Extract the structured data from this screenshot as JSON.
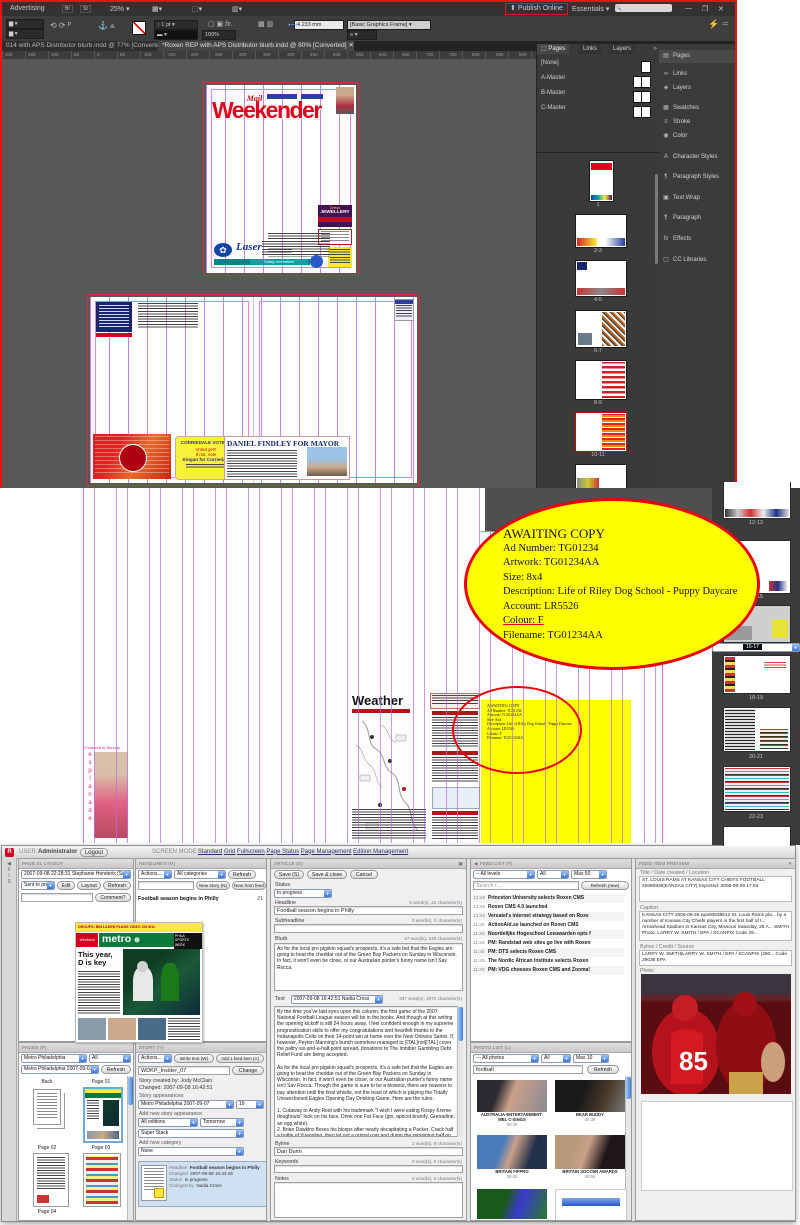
{
  "indesign": {
    "app_bar": {
      "workspace": "Advertising",
      "zoom": "25%",
      "publish": "Publish Online",
      "essentials": "Essentials"
    },
    "control_bar": {
      "stroke_weight": "1 pt",
      "percent": "100%",
      "measure": "4.233 mm",
      "frame_style": "[Basic Graphics Frame]"
    },
    "tabs": [
      {
        "label": "014 with APS Distributor blurb.indd @ 77% [Converted]"
      },
      {
        "label": "*Roxen REP with APS Distributor blurb.indd @ 80% [Converted]"
      }
    ],
    "ruler": [
      "200",
      "150",
      "100",
      "50",
      "0",
      "50",
      "100",
      "150",
      "200",
      "250",
      "300",
      "350",
      "400",
      "450",
      "500",
      "550",
      "600",
      "650",
      "700",
      "750",
      "800",
      "850",
      "900"
    ],
    "pages_panel": {
      "tabs": [
        "Pages",
        "Links",
        "Layers"
      ],
      "masters": [
        "[None]",
        "A-Master",
        "B-Master",
        "C-Master"
      ],
      "page_labels": [
        "1",
        "2-3",
        "4-5",
        "6-7",
        "8-9",
        "10-11"
      ]
    },
    "dock": [
      "Pages",
      "Links",
      "Layers",
      "Swatches",
      "Stroke",
      "Color",
      "Character Styles",
      "Paragraph Styles",
      "Text Wrap",
      "Paragraph",
      "Effects",
      "CC Libraries"
    ],
    "page1": {
      "masthead_small": "Mail",
      "masthead": "Weekender",
      "laser": "Laser",
      "jewellery1": "Dress",
      "jewellery2": "JEWELLERY",
      "totally": "Totally Incredible!"
    },
    "spread": {
      "yellow_ad": {
        "l1": "CORRIEDALE VOTERS",
        "l2": "Voted yet?",
        "l3": "If not, vote",
        "l4": "Kingan for Corriedale"
      },
      "mayor_ad": {
        "title": "DANIEL FINDLEY FOR MAYOR"
      }
    }
  },
  "zoom_view": {
    "thumb_labels": [
      "12-13",
      "14-15",
      "16-17",
      "18-19",
      "20-21",
      "22-23"
    ],
    "weather_title": "Weather",
    "featured": {
      "caption": "Featured in Sunday",
      "vertical": "esplanade"
    },
    "ticket": {
      "title": "AWAITING COPY",
      "ad_number": "Ad Number: TG01234",
      "artwork": "Artwork: TG01234AA",
      "size": "Size: 8x4",
      "description": "Description: Life of Riley Dog School - Puppy Daycare",
      "account": "Account: LR5526",
      "colour": "Colour: F",
      "filename": "Filename: TG01234AA"
    }
  },
  "cms": {
    "header": {
      "user_label": "USER:",
      "user": "Administrator",
      "logout": "Logout",
      "mode_label": "SCREEN MODE:",
      "nav": [
        "Standard",
        "Grid",
        "Fullscreen",
        "Page Status",
        "Page Management",
        "Edition Management"
      ]
    },
    "page_layout": {
      "title": "PAGE 01 LAYOUT",
      "revision": "2007-09-08 22:28:31 Stephanie Henderix (Sent t",
      "sent": "Sent to pre",
      "edit": "Edit",
      "layout": "Layout",
      "refresh": "Refresh",
      "comment": "Comment?"
    },
    "headlines": {
      "title": "HEADLINES (H)",
      "actions": "Actions...",
      "categories": "All categories",
      "refresh": "Refresh",
      "new_story": "New story (N)",
      "new_from_feed": "New from feed",
      "item": "Football season begins in Philly",
      "item_page": "21"
    },
    "preview": {
      "topline": "GROUPS: BIN LADEN PLANS VIDEO ON 9/11",
      "brand": "metro",
      "brand_left": "Weekend",
      "headline1": "This year,",
      "headline2": "D is key"
    },
    "pages": {
      "title": "PAGES (P)",
      "pub": "Metro Philadelphia",
      "all": "All",
      "edition": "Metro Philadelphia 2007-09-07",
      "refresh": "Refresh",
      "thumbs": [
        "Back",
        "Page 01",
        "Page 02",
        "Page 03",
        "Page 04"
      ]
    },
    "story": {
      "title": "STORY (Y)",
      "actions": "Actions...",
      "write": "Write text (W)",
      "add_feed": "Add 1 feed item (A)",
      "slug": "WDKP_Insider_07",
      "change": "Change",
      "created": "Story created by: Jody McClain",
      "changed": "Changed: 2007-09-08 16:42:51",
      "appearances_label": "Story appearances",
      "appearance": "Metro Philadelphia 2007-09-07",
      "page_no": "19",
      "add_appearance_label": "Add new story appearance",
      "editions": "All editions",
      "when": "Tomorrow",
      "stack": "Super Stack",
      "add_category_label": "Add new category",
      "category": "None",
      "item": {
        "headline_label": "Headline",
        "headline": "Football season begins in Philly",
        "changed_label": "Changed",
        "changed": "2007-09-08 16:43:45",
        "status_label": "Status",
        "status": "In progress",
        "by_label": "Changed by",
        "by": "Nadia Cross"
      }
    },
    "article": {
      "title": "ARTICLE (S)",
      "save": "Save (S)",
      "save_close": "Save & close",
      "cancel": "Cancel",
      "status_label": "Status",
      "status": "In progress",
      "headline_label": "Headline",
      "headline_count": "5 word(s), 32 character(s)",
      "headline": "Football season begins in Philly",
      "subheadline_label": "Subheadline",
      "subheadline_count": "0 word(s), 0 character(s)",
      "blurb_label": "Blurb",
      "blurb_count": "47 word(s), 246 character(s)",
      "blurb": "As for the local pro pigskin squad's prospects, it's a safe bet that the Eagles are going to beat the cheddar out of the Green Bay Packers on Sunday in Wisconsin. In fact, it won't even be close, or our Australian punter's funny name isn't Sav Rocca.",
      "text_label": "Text",
      "text_rev": "2007-09-08 16:42:51 Nadia Cross",
      "text_count": "337 word(s), 1972 character(s)",
      "text": "By the time you've laid eyes upon this column, the first game of the 2007 National Football League season will be in the books. And though at this writing the opening kickoff is still 24 hours away, I feel confident enough in my supreme prognostication skills to offer my congratulations and heartfelt thanks to the Indianapolis Colts on their 14-point win at home over the New Orleans Saints. If, however, Peyton Manning's bunch somehow managed to [ITAL]not[ITAL] cover the paltry six-and-a-half point spread, donations to The Imbiber Gambling Debt Relief Fund are being accepted.\n\nAs for the local pro pigskin squad's prospects, it's a safe bet that the Eagles are going to beat the cheddar out of the Green Bay Packers on Sunday in Wisconsin. In fact, it won't even be close, or our Australian punter's funny name isn't Sav Rocca. Though the game is sure to be a blowout, there are reasons to pay attention until the final whistle, not the least of which is playing the Totally Unsanctioned Eagles Opening Day Drinking Game. Here are the rules:\n\n1. Cutaway to Andy Reid with his trademark \"I wish I were eating Krispy Kreme doughnuts\" look on his face. Drink one Fat Face (gin, apricot brandy, Grenadine, an egg white).\n2. Brian Dawkins flexes his biceps after nearly decapitating a Packer. Crack half a bottle of Yuengling, then let out a primal roar and dump the remaining half on the head of the person sitting closest to you.\n3. Sav Rocca punts: Two sips of Foster's, which is Australian for beer. Too many punts, however, and you may want to \"chunder,\" which is Australian for puke.\n4. Donovan McNabb chunders: Think back to the exciting moments of Super Bowl XXXIX, then swallow a Bitter Pill (vodka, Jack Daniel, lemon juice, Coke).\n5. Hear the E-A-G-L-E-S chant emanating from the crowd at Lambeau Field: Raise a shot of Brass Balls (Grand Marnier, peach schnapps, pineapple juice) to intrepid Birds fans everywhere.\n\nFinal score prediction: Eagles 24, Packers 16.",
      "byline_label": "Byline",
      "byline_count": "2 word(s), 8 character(s)",
      "byline": "Dan Dunn",
      "keywords_label": "Keywords",
      "keywords_count": "0 word(s), 0 character(s)",
      "notes_label": "Notes",
      "notes_count": "0 word(s), 0 character(s)"
    },
    "feed": {
      "title": "FEED LIST (F)",
      "levels": "-- All levels",
      "all": "All",
      "max": "Max 50",
      "search": "Search t...",
      "refresh": "Refresh (new)",
      "items": [
        {
          "time": "13:48",
          "title": "Princeton University selects Roxen CMS"
        },
        {
          "time": "13:48",
          "title": "Roxen CMS 4.0 launched"
        },
        {
          "time": "13:48",
          "title": "Versatel's internet strategy based on Roxe"
        },
        {
          "time": "11:25",
          "title": "ActionAid.se launched on Roxen CMS"
        },
        {
          "time": "11:25",
          "title": "Noordelijke Hogeschool Leeuwarden opts f"
        },
        {
          "time": "11:25",
          "title": "PM: Randstad web sites go live with Roxen"
        },
        {
          "time": "11:25",
          "title": "PM: DTS selects Roxen CMS"
        },
        {
          "time": "11:25",
          "title": "The Nordic African Institute selects Roxen"
        },
        {
          "time": "11:25",
          "title": "PM: VDG chooses Roxen CMS and Zooma!"
        }
      ]
    },
    "photos": {
      "title": "PHOTO LIST (L)",
      "filter": "--- All photos",
      "all": "All",
      "max": "Max 10",
      "search": "football",
      "refresh": "Refresh",
      "items": [
        {
          "caption": "AUSTRALIA-ENTERTAINMENT-MEL C-SINGS",
          "time": "08:39"
        },
        {
          "caption": "BEAR BUDDY",
          "time": "08:39"
        },
        {
          "caption": "BRITAIN FIFPRO",
          "time": "08:53"
        },
        {
          "caption": "BRITAIN SOCCER AWARDS",
          "time": "08:55"
        }
      ]
    },
    "feed_item": {
      "title": "FEED ITEM PREVIEW",
      "title_label": "Title / Date created / Location",
      "item_title": "ST. LOUIS RAMS AT KANSAS CITY CHIEFS FOOTBALL 20060826|KANSAS CITY| Imported: 2008-08-29 17:54",
      "caption_label": "Caption",
      "caption": "KANSAS CITY 2006-08-26 epa00838812 St. Louis Rams pla... by a number of Kansas City Chiefs players in the first half of t... Arrowhead Stadium in Kansas City, Missouri Saturday, 26 A... SMITH Photo: LARRY W. SMITH / EPA / SCANPIX Code 29...",
      "byline_label": "Byline / Credit / Source",
      "byline": "LARRY W. SMITH|LARRY W. SMITH / EPA / SCANPIX (290... Code 29036 EPA",
      "photo_label": "Photo"
    }
  },
  "colors": {
    "annotation_red": "#e8000a",
    "ticket_yellow": "#ffff00",
    "guide_violet": "#ba6ae8",
    "masthead_red": "#e2001a"
  }
}
